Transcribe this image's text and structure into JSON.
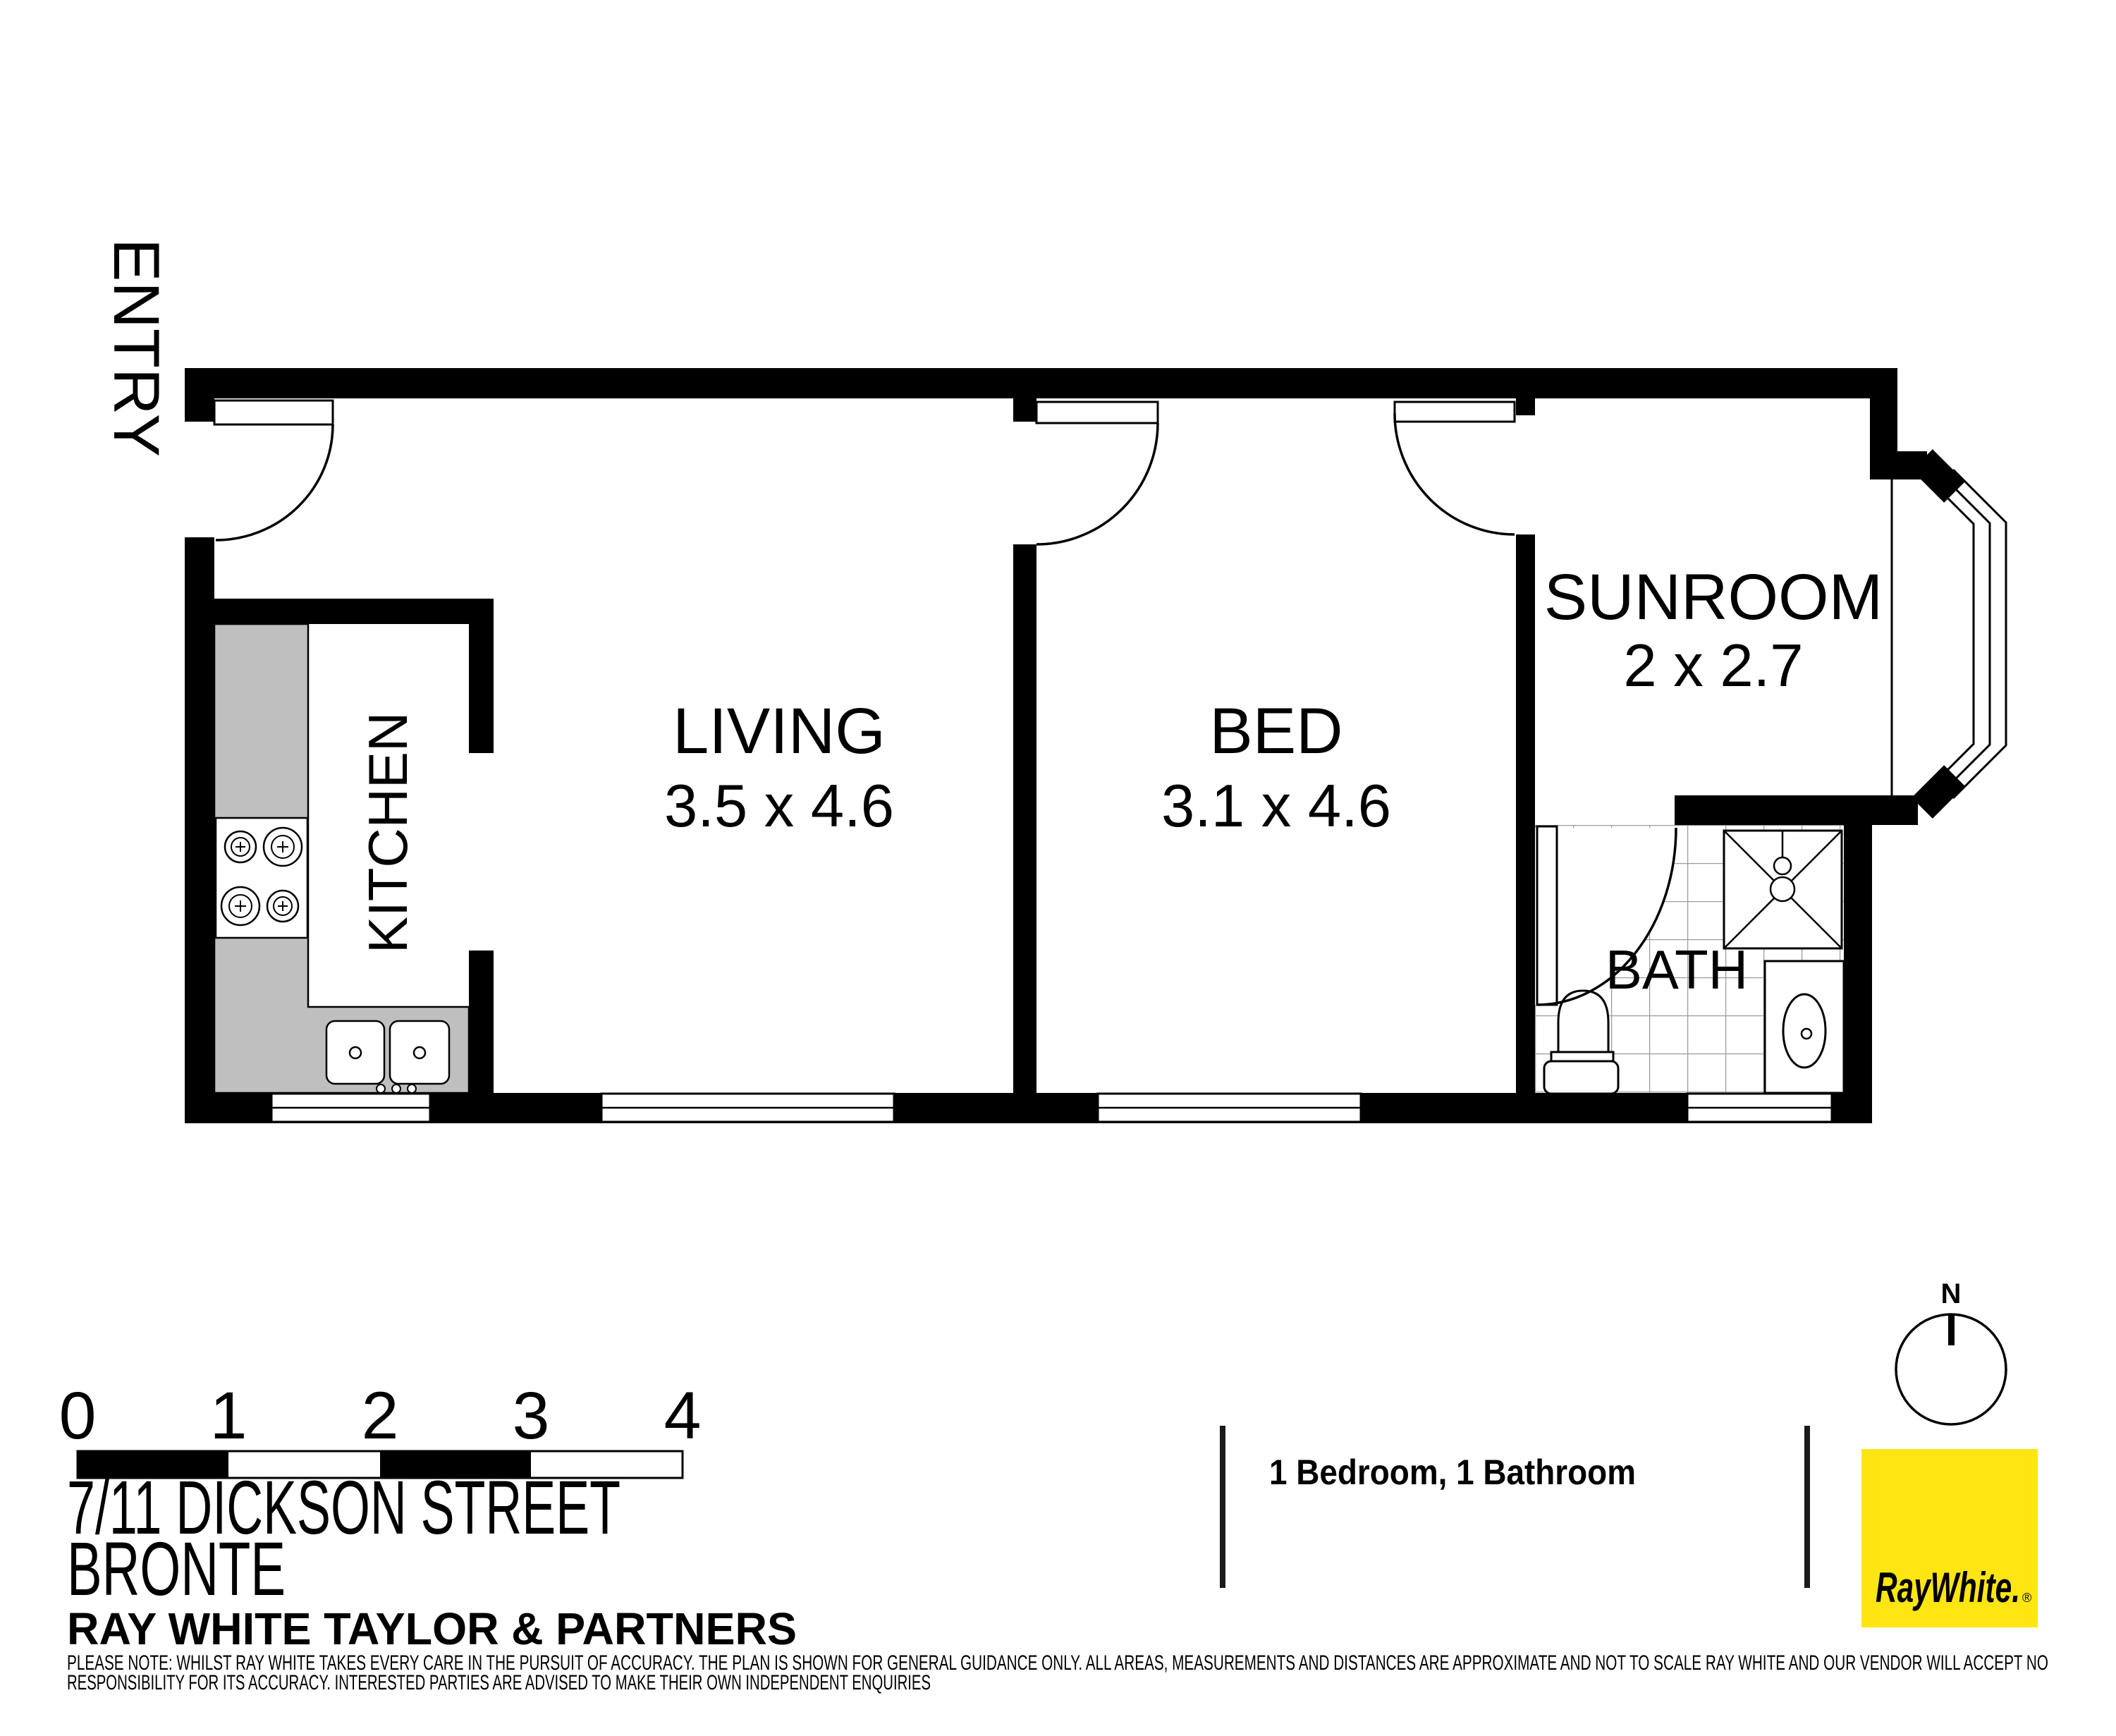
{
  "rooms": {
    "living": {
      "label": "LIVING",
      "dims": "3.5 x 4.6"
    },
    "bed": {
      "label": "BED",
      "dims": "3.1 x 4.6"
    },
    "sunroom": {
      "label": "SUNROOM",
      "dims": "2 x 2.7"
    },
    "kitchen": {
      "label": "KITCHEN"
    },
    "bath": {
      "label": "BATH"
    },
    "entry": {
      "label": "ENTRY"
    }
  },
  "scale_bar": {
    "ticks": [
      "0",
      "1",
      "2",
      "3",
      "4"
    ]
  },
  "address": {
    "street": "7/11 DICKSON STREET",
    "suburb": "BRONTE",
    "agency": "RAY WHITE TAYLOR & PARTNERS"
  },
  "summary": {
    "text": "1 Bedroom, 1 Bathroom"
  },
  "north": {
    "label": "N"
  },
  "logo": {
    "text": "RayWhite.",
    "registered_mark": "®"
  },
  "disclaimer": {
    "line1": "PLEASE NOTE: WHILST RAY WHITE TAKES EVERY CARE IN THE PURSUIT OF ACCURACY. THE PLAN IS SHOWN FOR GENERAL GUIDANCE ONLY. ALL AREAS, MEASUREMENTS AND DISTANCES ARE APPROXIMATE AND NOT TO SCALE RAY WHITE AND OUR VENDOR WILL ACCEPT NO",
    "line2": "RESPONSIBILITY FOR ITS ACCURACY. INTERESTED PARTIES ARE ADVISED TO MAKE THEIR OWN INDEPENDENT ENQUIRIES"
  },
  "colors": {
    "wall": "#000000",
    "counter": "#BFBFBF",
    "tile_line": "#9B9B9B",
    "logo_bg": "#FFE512",
    "logo_fg": "#5B5B5E"
  }
}
